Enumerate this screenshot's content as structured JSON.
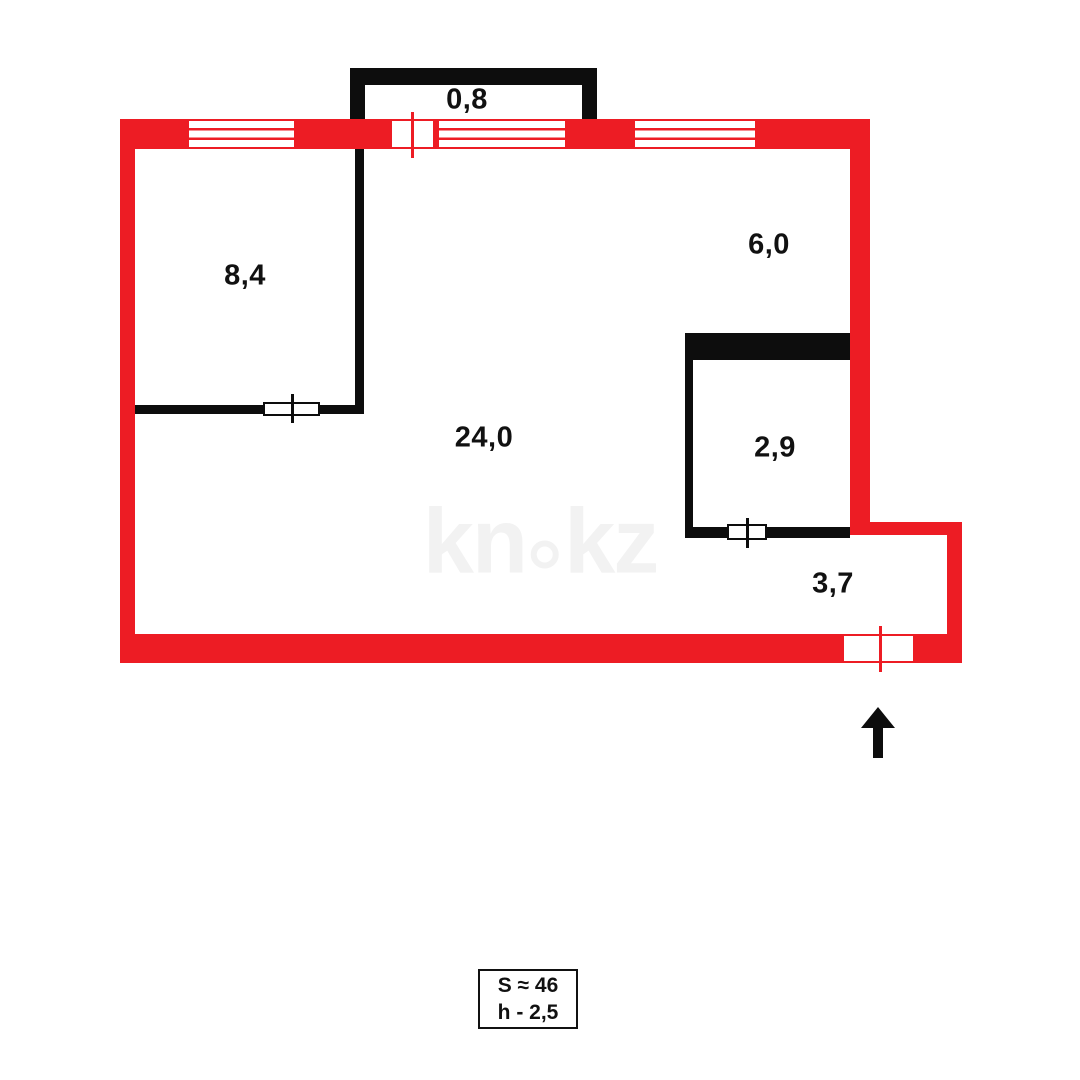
{
  "diagram": {
    "type": "apartment-floor-plan",
    "watermark": {
      "text_left": "kn",
      "text_right": "kz"
    },
    "summary_box": {
      "total_area": "S ≈ 46",
      "ceiling_height": "h - 2,5"
    },
    "rooms": {
      "balcony": {
        "area": "0,8"
      },
      "bedroom": {
        "area": "8,4"
      },
      "kitchen": {
        "area": "6,0"
      },
      "living_room": {
        "area": "24,0"
      },
      "bathroom": {
        "area": "2,9"
      },
      "hallway": {
        "area": "3,7"
      }
    }
  },
  "colors": {
    "wall_red": "#ed1c24",
    "wall_black": "#0d0d0d",
    "watermark_gray": "#f2f2f2",
    "background": "#ffffff",
    "label_text": "#111111"
  }
}
